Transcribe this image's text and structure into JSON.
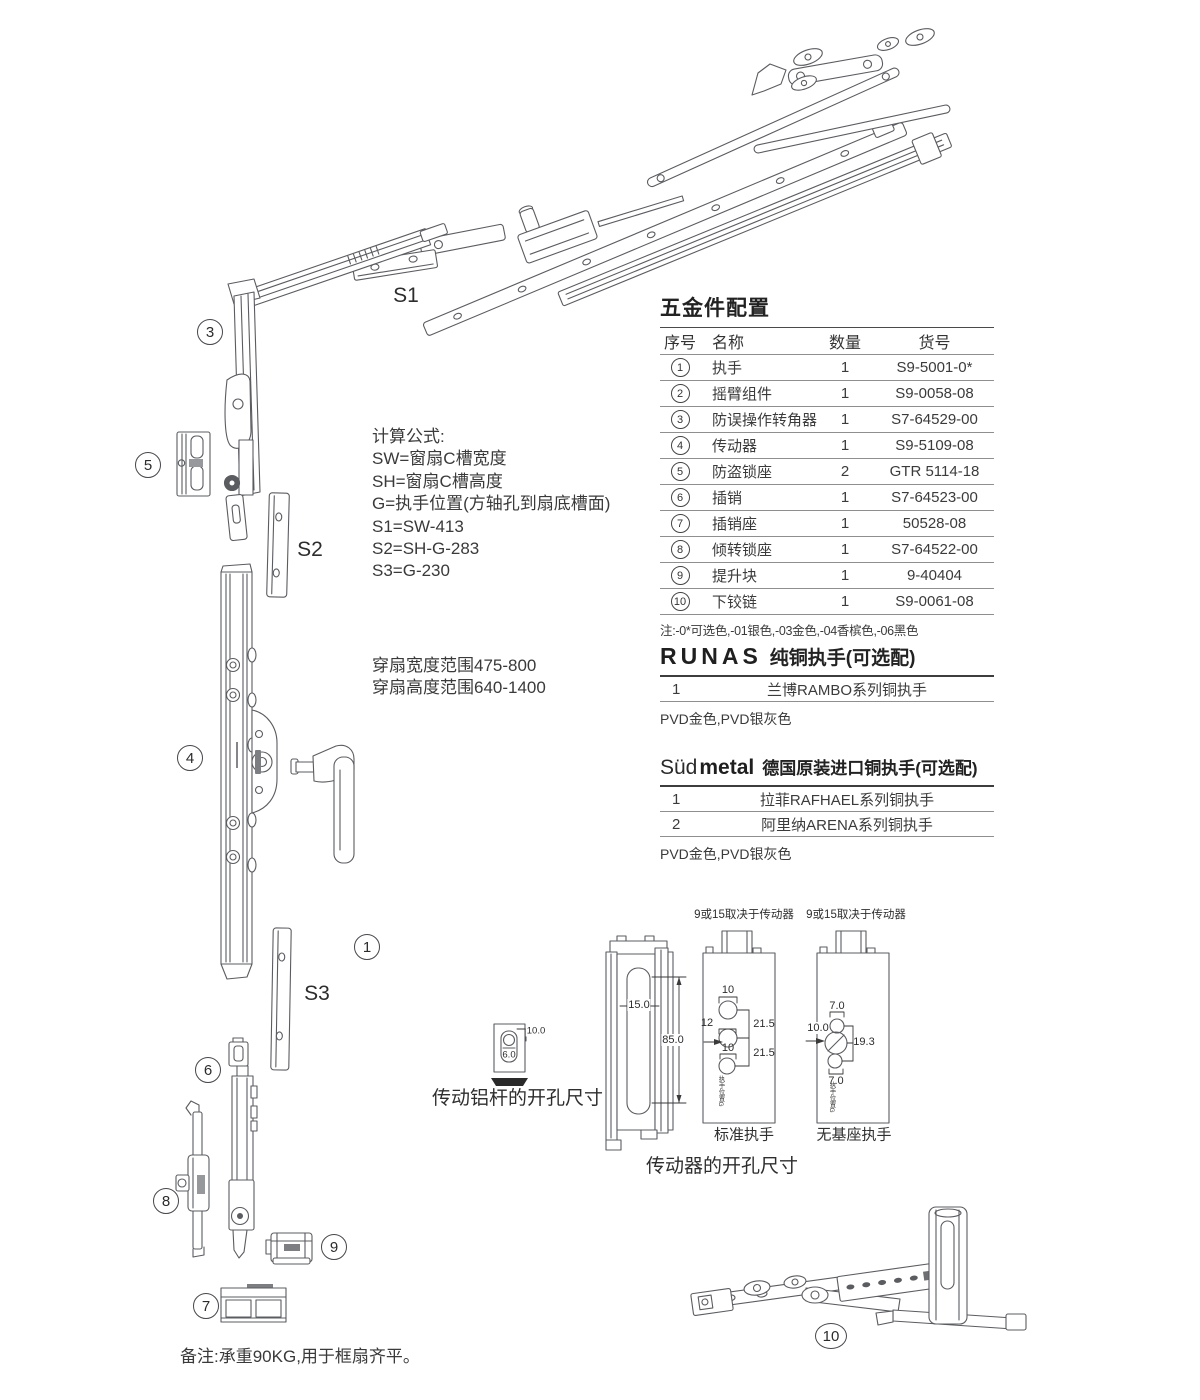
{
  "parts_table": {
    "title": "五金件配置",
    "headers": [
      "序号",
      "名称",
      "数量",
      "货号"
    ],
    "rows": [
      {
        "no": "1",
        "name": "执手",
        "qty": "1",
        "code": "S9-5001-0*"
      },
      {
        "no": "2",
        "name": "摇臂组件",
        "qty": "1",
        "code": "S9-0058-08"
      },
      {
        "no": "3",
        "name": "防误操作转角器",
        "qty": "1",
        "code": "S7-64529-00"
      },
      {
        "no": "4",
        "name": "传动器",
        "qty": "1",
        "code": "S9-5109-08"
      },
      {
        "no": "5",
        "name": "防盗锁座",
        "qty": "2",
        "code": "GTR 5114-18"
      },
      {
        "no": "6",
        "name": "插销",
        "qty": "1",
        "code": "S7-64523-00"
      },
      {
        "no": "7",
        "name": "插销座",
        "qty": "1",
        "code": "50528-08"
      },
      {
        "no": "8",
        "name": "倾转锁座",
        "qty": "1",
        "code": "S7-64522-00"
      },
      {
        "no": "9",
        "name": "提升块",
        "qty": "1",
        "code": "9-40404"
      },
      {
        "no": "10",
        "name": "下铰链",
        "qty": "1",
        "code": "S9-0061-08"
      }
    ],
    "note": "注:-0*可选色,-01银色,-03金色,-04香槟色,-06黑色"
  },
  "runas": {
    "brand": "RUNAS",
    "title": "纯铜执手(可选配)",
    "rows": [
      {
        "no": "1",
        "name": "兰博RAMBO系列铜执手"
      }
    ],
    "finish": "PVD金色,PVD银灰色"
  },
  "sudmetal": {
    "brand_light": "Süd",
    "brand_bold": "metal",
    "title": "德国原装进口铜执手(可选配)",
    "rows": [
      {
        "no": "1",
        "name": "拉菲RAFHAEL系列铜执手"
      },
      {
        "no": "2",
        "name": "阿里纳ARENA系列铜执手"
      }
    ],
    "finish": "PVD金色,PVD银灰色"
  },
  "formulas": {
    "title": "计算公式:",
    "lines": [
      "SW=窗扇C槽宽度",
      "SH=窗扇C槽高度",
      "G=执手位置(方轴孔到扇底槽面)",
      "S1=SW-413",
      "S2=SH-G-283",
      "S3=G-230"
    ]
  },
  "ranges": {
    "lines": [
      "穿扇宽度范围475-800",
      "穿扇高度范围640-1400"
    ]
  },
  "diagram": {
    "callouts": [
      {
        "label": "3"
      },
      {
        "label": "5"
      },
      {
        "label": "4"
      },
      {
        "label": "1"
      },
      {
        "label": "6"
      },
      {
        "label": "8"
      },
      {
        "label": "9"
      },
      {
        "label": "7"
      },
      {
        "label": "10"
      }
    ],
    "size_labels": [
      {
        "text": "S1"
      },
      {
        "text": "S2"
      },
      {
        "text": "S3"
      }
    ]
  },
  "drill": {
    "rod_title": "传动铝杆的开孔尺寸",
    "driver_title": "传动器的开孔尺寸",
    "std_label": "标准执手",
    "nobase_label": "无基座执手",
    "top_note": "9或15取决于传动器",
    "handle_pos": "执手位置G",
    "dims": {
      "w15": "15.0",
      "h85": "85.0",
      "d10a": "10",
      "d12": "12",
      "d10b": "10",
      "g215a": "21.5",
      "g215b": "21.5",
      "e70a": "7.0",
      "e100": "10.0",
      "e193": "19.3",
      "e70b": "7.0",
      "r100": "10.0",
      "r60": "6.0"
    }
  },
  "footer": {
    "note": "备注:承重90KG,用于框扇齐平。"
  }
}
